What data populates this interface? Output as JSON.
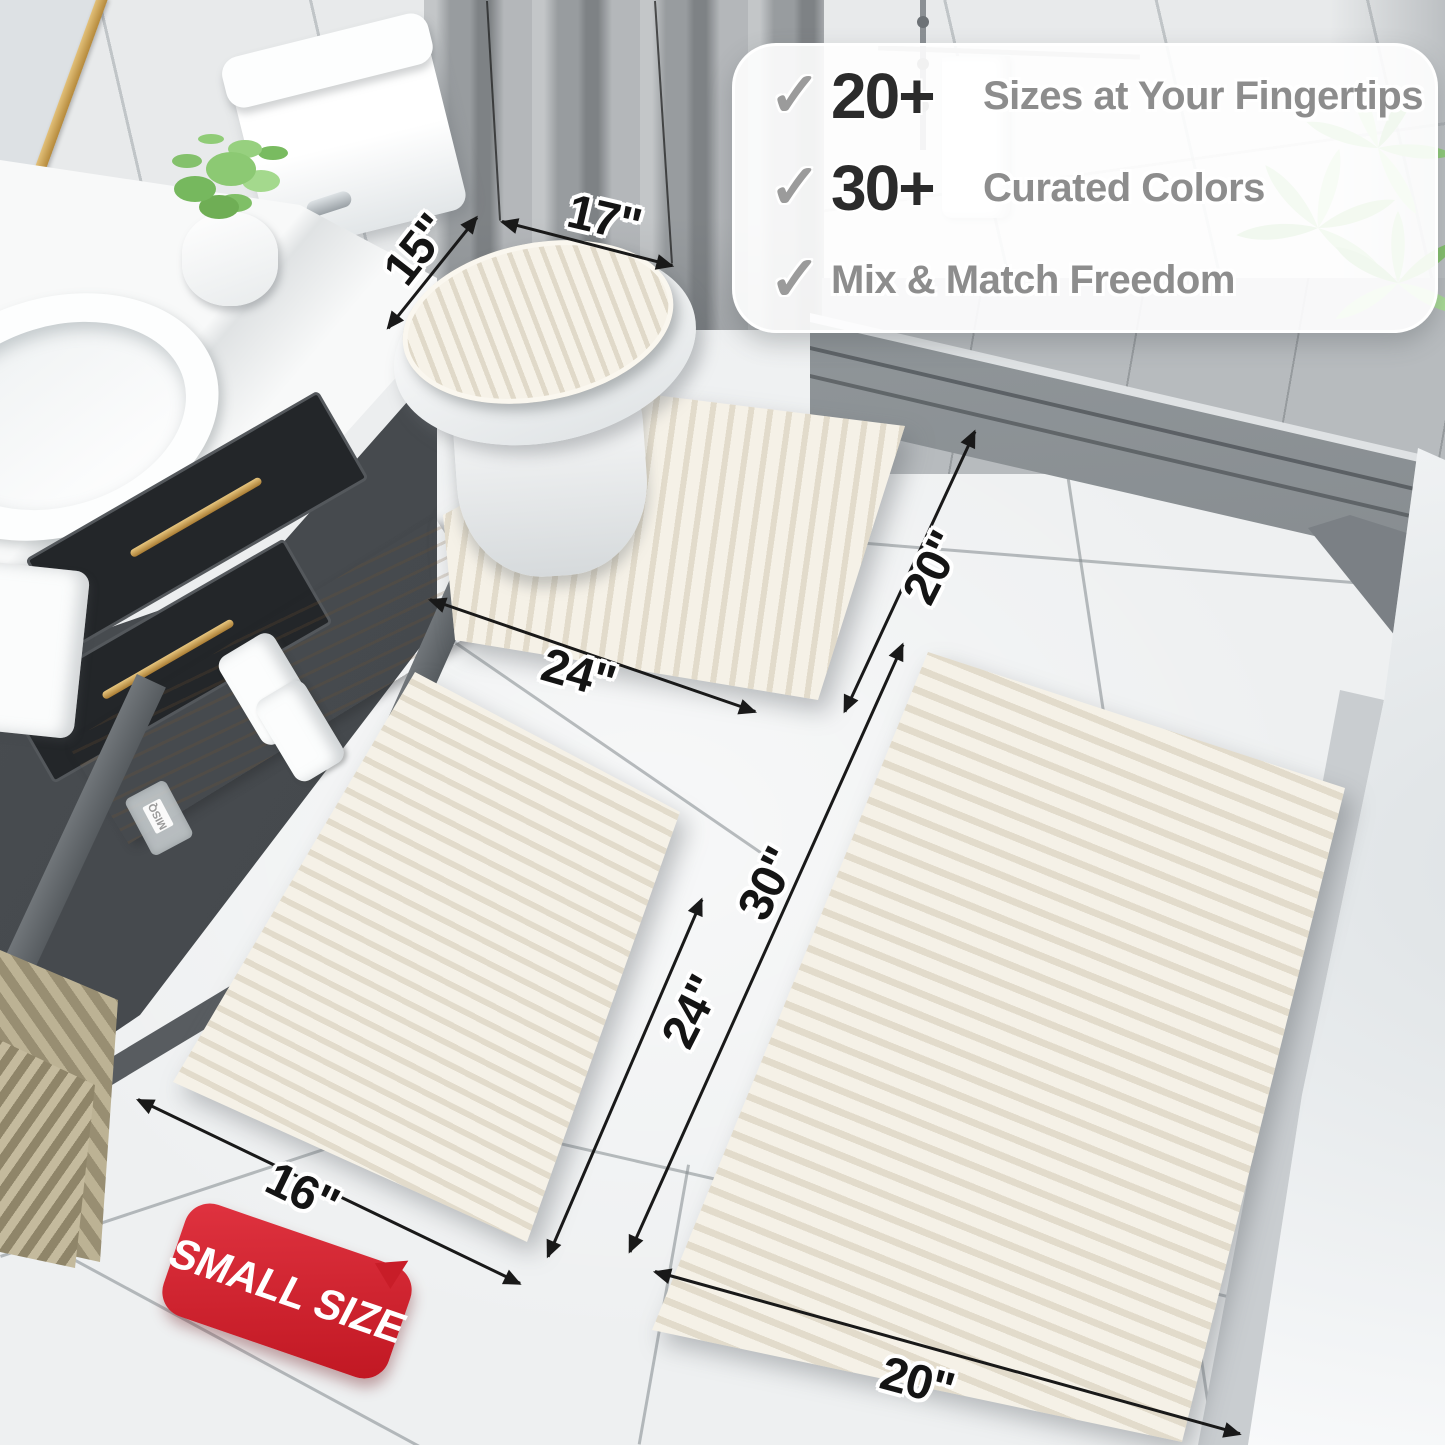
{
  "callout": {
    "items": [
      {
        "icon": "✓",
        "value": "20+",
        "label": "Sizes at Your Fingertips"
      },
      {
        "icon": "✓",
        "value": "30+",
        "label": "Curated Colors"
      },
      {
        "icon": "✓",
        "value": "",
        "label": "Mix & Match Freedom"
      }
    ]
  },
  "dimensions": {
    "lid_depth": "15\"",
    "lid_width": "17\"",
    "contour_width": "24\"",
    "contour_depth": "20\"",
    "small_width": "16\"",
    "small_length": "24\"",
    "large_length": "30\"",
    "large_width": "20\""
  },
  "badge": {
    "text": "SMALL SIZE"
  },
  "bottle_label": "MISQ",
  "colors": {
    "accent_red": "#c81d28",
    "dimension_text": "#141414",
    "callout_number": "#2b2b2b",
    "callout_text": "#8d8d8d",
    "check_gray": "#9b9b9b",
    "rug_cream": "#f5f1e7"
  }
}
